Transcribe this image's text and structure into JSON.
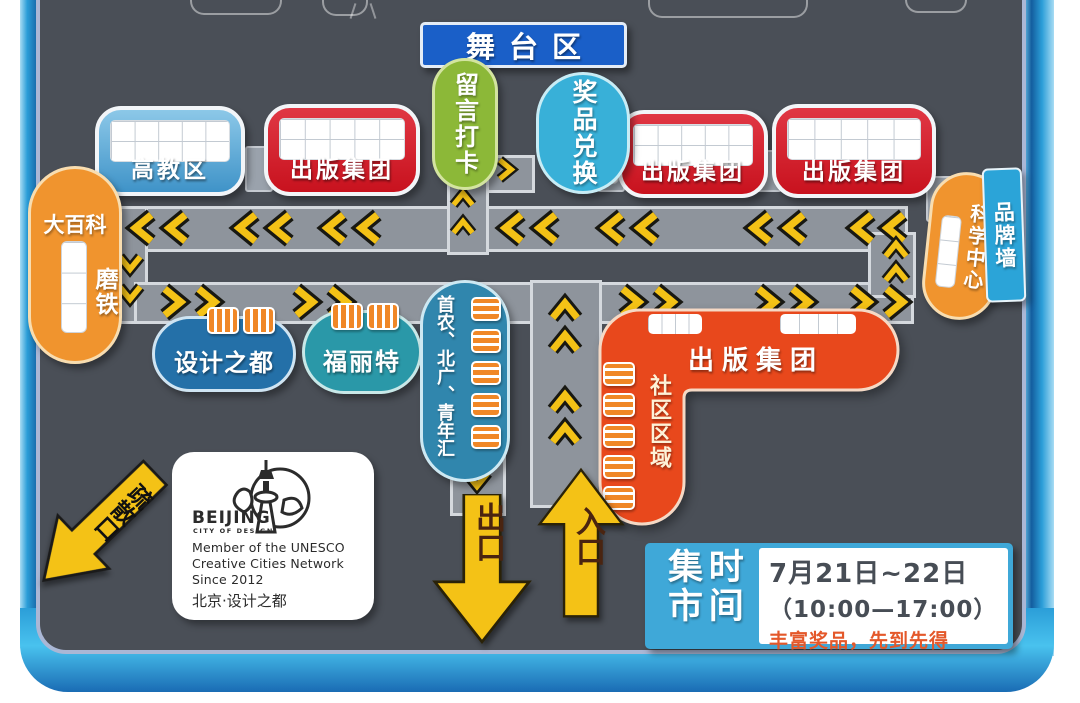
{
  "stage": {
    "label": "舞台区"
  },
  "booths": {
    "higher_ed": "高教区",
    "publishing": "出版集团",
    "message_checkin": "留言打卡",
    "prize_exchange": "奖品兑换",
    "science_center": "科学中心",
    "brand_wall": "品牌墙",
    "encyclopedia": "大百科",
    "motie": "磨铁",
    "design_capital": "设计之都",
    "fulite": "福丽特",
    "shounong_beiguang_youth": "首农、北广、青年汇",
    "community_zone": "社区区域"
  },
  "signs": {
    "evacuation_exit": "疏散口",
    "exit": "出口",
    "entrance": "入口"
  },
  "logo": {
    "brand": "BEIJING",
    "brand_sub": "CITY OF DESIGN",
    "member1": "Member of the UNESCO",
    "member2": "Creative Cities Network",
    "member3": "Since 2012",
    "cn_name": "北京·设计之都"
  },
  "schedule": {
    "title_col_left": "集市",
    "title_col_right": "时间",
    "dates": "7月21日~22日",
    "hours": "（10:00—17:00）",
    "note": "丰富奖品，先到先得"
  },
  "colors": {
    "accent_yellow": "#f4c216",
    "booth_red": "#c8121e",
    "booth_blue": "#4fa3d6",
    "stage_blue": "#1a5fc8",
    "oval_green": "#8cb838",
    "oval_cyan": "#38b0d8",
    "oval_orange": "#f0942e",
    "community_red": "#e8481c",
    "platform_blue": "#2b9ed8"
  }
}
